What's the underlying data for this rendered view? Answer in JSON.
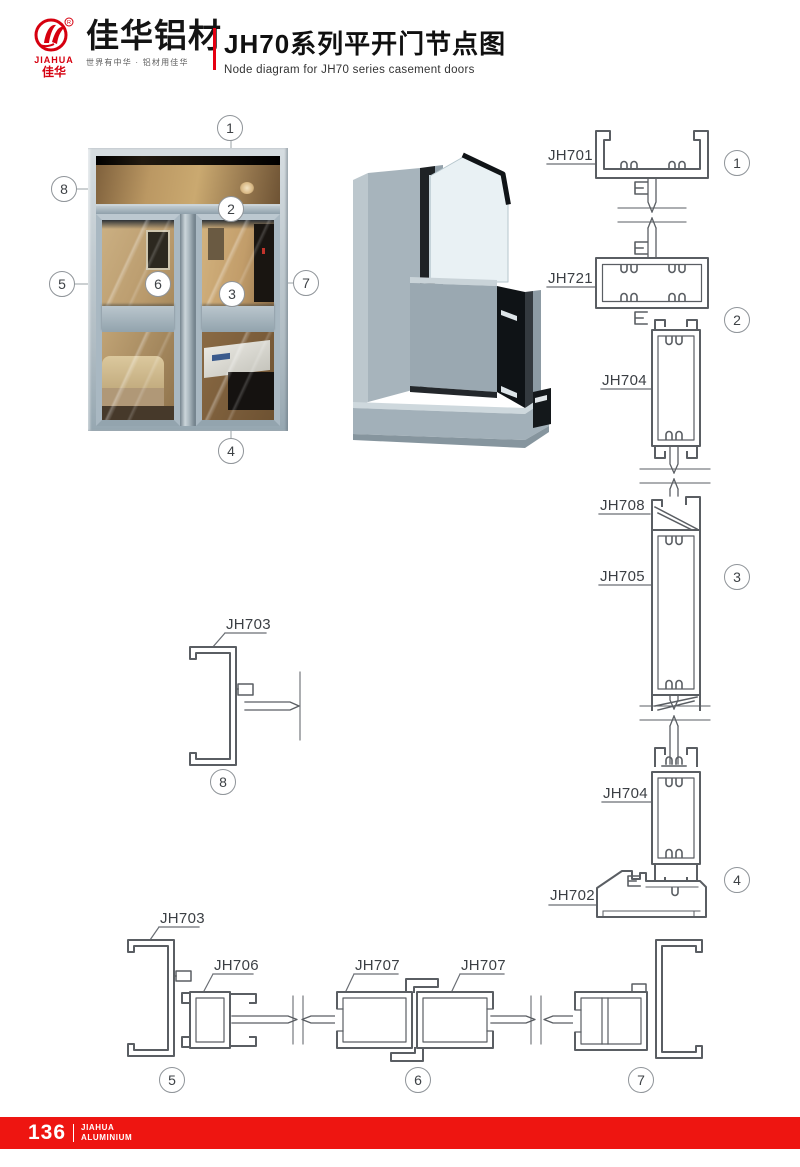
{
  "header": {
    "logo": {
      "brand_en": "JIAHUA",
      "brand_cn": "佳华",
      "registered": "®"
    },
    "company_name": "佳华铝材",
    "tagline": "世界有中华 · 铝材用佳华",
    "title_cn": "JH70系列平开门节点图",
    "title_en": "Node diagram for JH70 series casement doors"
  },
  "colors": {
    "accent_red": "#e60012",
    "footer_red": "#ee1511",
    "drawing_line": "#5a5e63"
  },
  "labels": [
    {
      "text": "JH701"
    },
    {
      "text": "JH721"
    },
    {
      "text": "JH704"
    },
    {
      "text": "JH708"
    },
    {
      "text": "JH705"
    },
    {
      "text": "JH704"
    },
    {
      "text": "JH702"
    },
    {
      "text": "JH703"
    },
    {
      "text": "JH703"
    },
    {
      "text": "JH706"
    },
    {
      "text": "JH707"
    },
    {
      "text": "JH707"
    }
  ],
  "callouts": [
    {
      "n": "1"
    },
    {
      "n": "2"
    },
    {
      "n": "3"
    },
    {
      "n": "4"
    },
    {
      "n": "5"
    },
    {
      "n": "6"
    },
    {
      "n": "7"
    },
    {
      "n": "8"
    },
    {
      "n": "1"
    },
    {
      "n": "2"
    },
    {
      "n": "3"
    },
    {
      "n": "4"
    },
    {
      "n": "8"
    },
    {
      "n": "5"
    },
    {
      "n": "6"
    },
    {
      "n": "7"
    }
  ],
  "footer": {
    "page_number": "136",
    "brand_line1": "JIAHUA",
    "brand_line2": "ALUMINIUM"
  }
}
